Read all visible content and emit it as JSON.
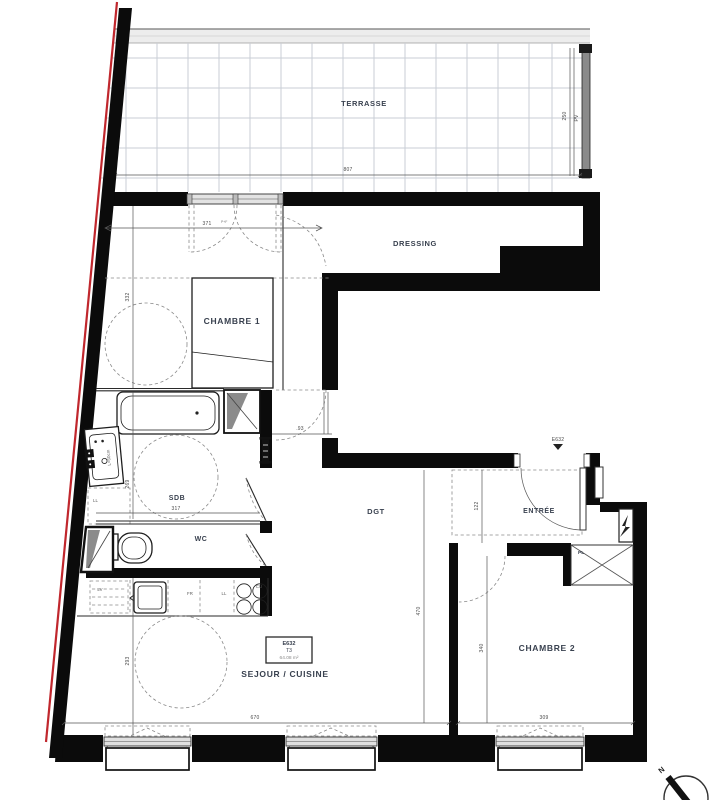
{
  "plan": {
    "rooms": {
      "terrasse": "TERRASSE",
      "dressing": "DRESSING",
      "chambre1": "CHAMBRE 1",
      "sdb": "SDB",
      "wc": "WC",
      "dgt": "DGT",
      "entree": "ENTRÉE",
      "chambre2": "CHAMBRE 2",
      "sejour": "SEJOUR / CUISINE",
      "placard": "PL"
    },
    "lot": {
      "code": "E632",
      "type": "T3",
      "area": "64.08 m²"
    },
    "entry_door": {
      "code": "E632"
    },
    "dimensions": {
      "terrasse_width": "807",
      "terrasse_depth": "250",
      "terrasse_window": "PV",
      "chambre1_width": "371",
      "chambre1_width_suffix": "P+F",
      "chambre1_depth": "332",
      "hall_door": ".93",
      "sdb_width": "317",
      "sdb_depth": "269",
      "entree_depth": "122",
      "dgt_depth": "470",
      "chambre2_depth": "340",
      "chambre2_width": "309",
      "sejour_width": "670",
      "sejour_depth": "293"
    },
    "kitchen": {
      "dishwasher": "LV",
      "fridge": "FR",
      "washer": "LL",
      "cooktop": "CU",
      "sink_label": "L=60cm",
      "sdb_washer": "LL"
    },
    "compass": {
      "north": "N"
    },
    "colors": {
      "wall": "#0b0b0b",
      "red_line": "#c0272d",
      "label": "#39414f",
      "dim_text": "#4a4a4a",
      "grid": "#c9cdd5"
    }
  }
}
